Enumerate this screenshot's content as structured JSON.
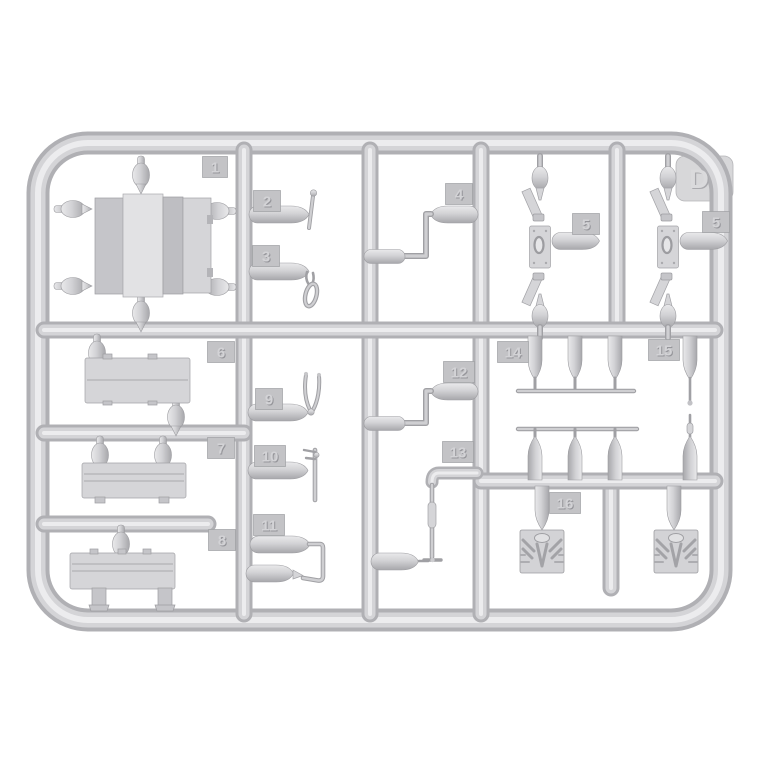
{
  "scene": {
    "description": "Photograph of a light-grey injection-moulded model kit sprue (parts runner) on a white background",
    "background_color": "#ffffff",
    "plastic_color": "#d2d2d5",
    "plastic_shadow_color": "#aeaeb2",
    "plastic_highlight_color": "#ececee"
  },
  "sprue": {
    "letter": "D",
    "tags": {
      "t1": "1",
      "t2": "2",
      "t3": "3",
      "t4": "4",
      "t5a": "5",
      "t5b": "5",
      "t6": "6",
      "t7": "7",
      "t8": "8",
      "t9": "9",
      "t10": "10",
      "t11": "11",
      "t12": "12",
      "t13": "13",
      "t14": "14",
      "t15": "15",
      "t16": "16"
    }
  }
}
